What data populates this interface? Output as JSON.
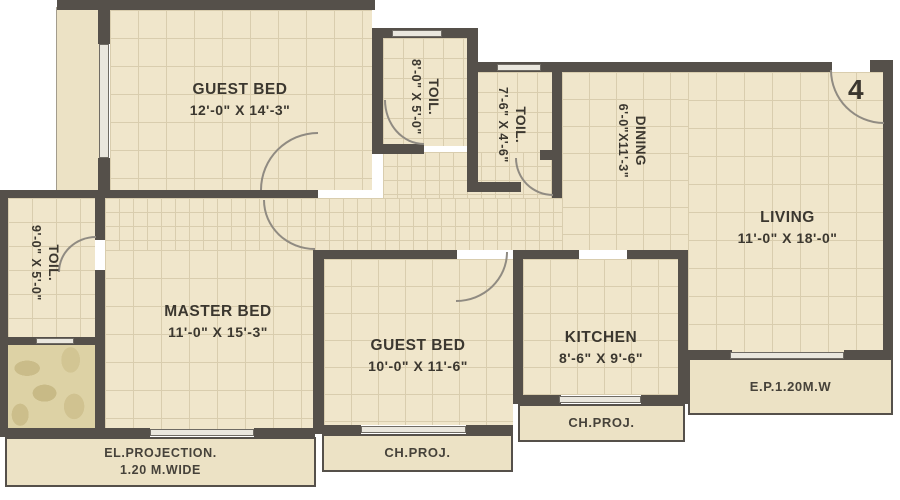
{
  "plan_title": "Residential Flat Floor Plan",
  "unit_number": "4",
  "rooms": [
    {
      "id": "guest-bed-1",
      "name": "GUEST BED",
      "dims": "12'-0\" X 14'-3\""
    },
    {
      "id": "toilet-top",
      "name": "TOIL.",
      "dims": "8'-0\" X 5'-0\""
    },
    {
      "id": "toilet-mid",
      "name": "TOIL.",
      "dims": "7'-6\" X 4'-6\""
    },
    {
      "id": "dining",
      "name": "DINING",
      "dims": "6'-0\"X11'-3\""
    },
    {
      "id": "living",
      "name": "LIVING",
      "dims": "11'-0\" X 18'-0\""
    },
    {
      "id": "toilet-left",
      "name": "TOIL.",
      "dims": "9'-0\" X 5'-0\""
    },
    {
      "id": "master-bed",
      "name": "MASTER BED",
      "dims": "11'-0\" X 15'-3\""
    },
    {
      "id": "guest-bed-2",
      "name": "GUEST BED",
      "dims": "10'-0\" X 11'-6\""
    },
    {
      "id": "kitchen",
      "name": "KITCHEN",
      "dims": "8'-6\" X 9'-6\""
    }
  ],
  "projections": {
    "ep": "E.P.1.20M.W",
    "ch_proj_kitchen": "CH.PROJ.",
    "ch_proj_guest": "CH.PROJ.",
    "el_line1": "EL.PROJECTION.",
    "el_line2": "1.20 M.WIDE"
  },
  "colors": {
    "wall": "#55504a",
    "floor": "#f0e6cb",
    "grid": "#d9cdae",
    "projection_fill": "#ece2c5",
    "window": "#eae7de",
    "text": "#3b372f",
    "background": "#ffffff"
  }
}
